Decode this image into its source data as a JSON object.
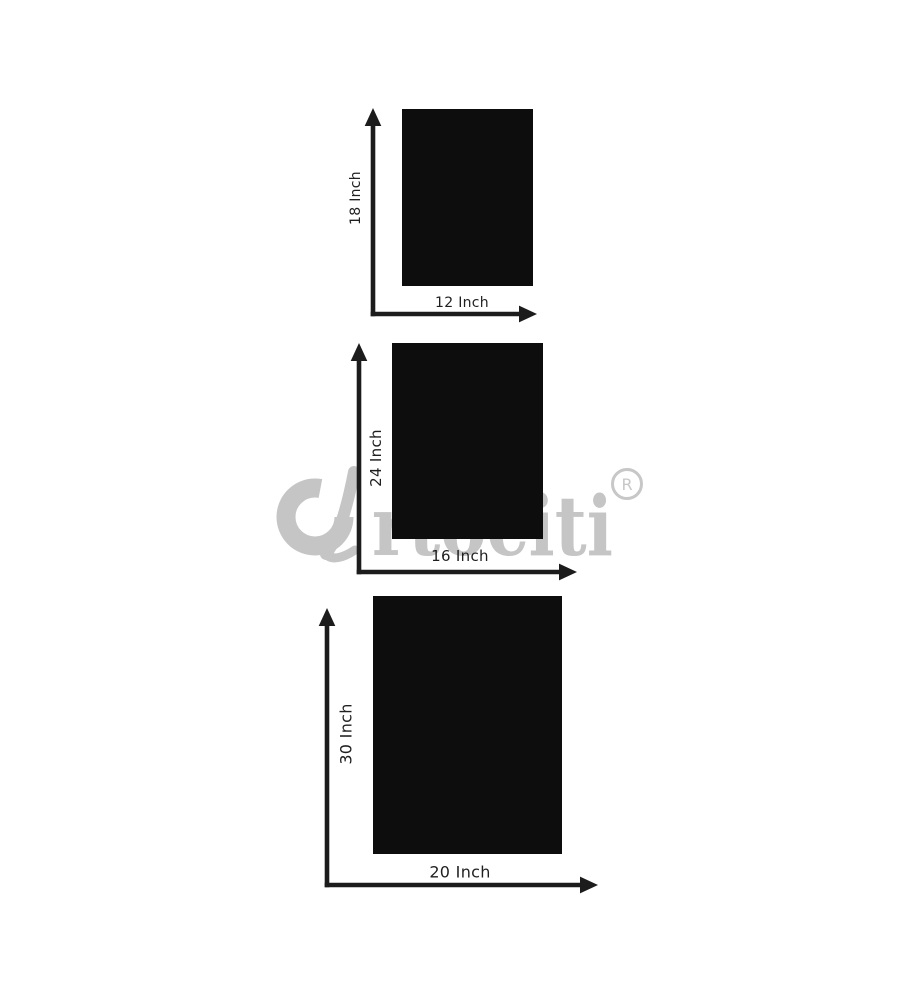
{
  "page": {
    "background": "#ffffff"
  },
  "watermark": {
    "brand_initial": "a",
    "brand_text": "rtociti",
    "registered_mark": "R",
    "color": "#c5c5c5"
  },
  "figures": [
    {
      "name": "small-frame",
      "height_label": "18 Inch",
      "width_label": "12 Inch"
    },
    {
      "name": "medium-frame",
      "height_label": "24 Inch",
      "width_label": "16 Inch"
    },
    {
      "name": "large-frame",
      "height_label": "30 Inch",
      "width_label": "20 Inch"
    }
  ],
  "colors": {
    "frame": "#0d0d0d",
    "arrow": "#1c1c1c",
    "label": "#1f1f1f",
    "background": "#ffffff"
  }
}
